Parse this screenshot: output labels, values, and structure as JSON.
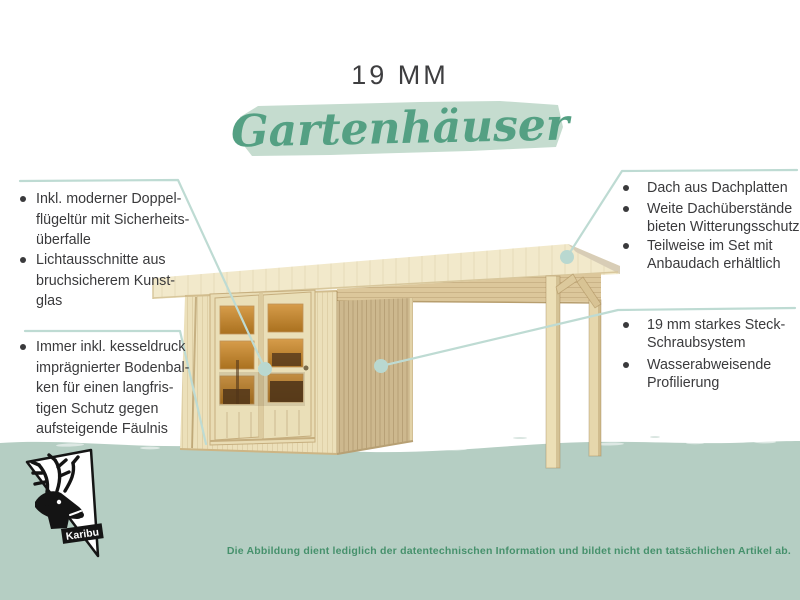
{
  "header": {
    "title": "19 MM",
    "subtitle": "Gartenhäuser"
  },
  "features_left": [
    {
      "lines": [
        "Inkl. moderner Doppel-",
        "flügeltür mit Sicherheits-",
        "überfalle"
      ]
    },
    {
      "lines": [
        "Lichtausschnitte aus",
        "bruchsicherem Kunst-",
        "glas"
      ]
    },
    {
      "lines": [
        "Immer inkl. kesseldruck",
        "imprägnierter Bodenbal-",
        "ken für einen langfris-",
        "tigen Schutz gegen",
        "aufsteigende Fäulnis"
      ]
    }
  ],
  "features_right_top": [
    {
      "lines": [
        "Dach aus Dachplatten"
      ]
    },
    {
      "lines": [
        "Weite Dachüberstände",
        "bieten Witterungsschutz"
      ]
    },
    {
      "lines": [
        "Teilweise im Set mit",
        "Anbaudach erhältlich"
      ]
    }
  ],
  "features_right_bottom": [
    {
      "lines": [
        "19 mm starkes Steck-",
        "Schraubsystem"
      ]
    },
    {
      "lines": [
        "Wasserabweisende",
        "Profilierung"
      ]
    }
  ],
  "footer": {
    "disclaimer": "Die Abbildung dient lediglich der datentechnischen Information und bildet nicht den tatsächlichen Artikel ab.",
    "logo_text": "Karibu"
  },
  "colors": {
    "band_green": "#b5cec3",
    "script_green": "#54a083",
    "brush_green": "#c5dccf",
    "leader_line": "#bedbd3",
    "body_text": "#3a3a3c",
    "disclaimer_text": "#46916c",
    "wood_light": "#ece0ba",
    "wood_dark": "#cdb88e",
    "glass_orange": "#c8882f"
  }
}
